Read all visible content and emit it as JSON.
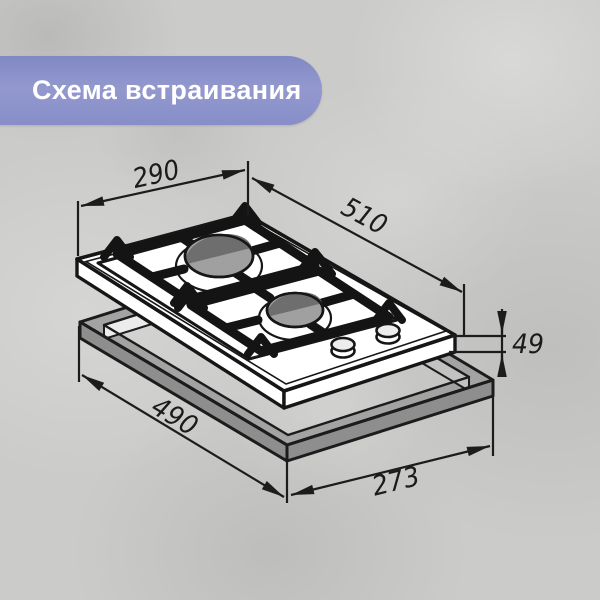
{
  "banner": {
    "title": "Схема встраивания",
    "bg_top": "#8189c4",
    "bg_bottom": "#878ec8",
    "text_color": "#ffffff"
  },
  "diagram": {
    "subject": "two-burner-gas-hob-installation-drawing",
    "dimensions": {
      "top_width": "290",
      "top_length": "510",
      "body_height": "49",
      "cutout_length": "490",
      "cutout_width": "273"
    },
    "colors": {
      "line": "#1c1c1c",
      "hob_surface": "#ffffff",
      "frame_top": "#a3a3a3",
      "frame_side": "#8e8e8e",
      "burner_cap": "#a0a0a0",
      "burner_cap_shadow": "#6e6e6e",
      "background": "#cbcbc9"
    }
  }
}
